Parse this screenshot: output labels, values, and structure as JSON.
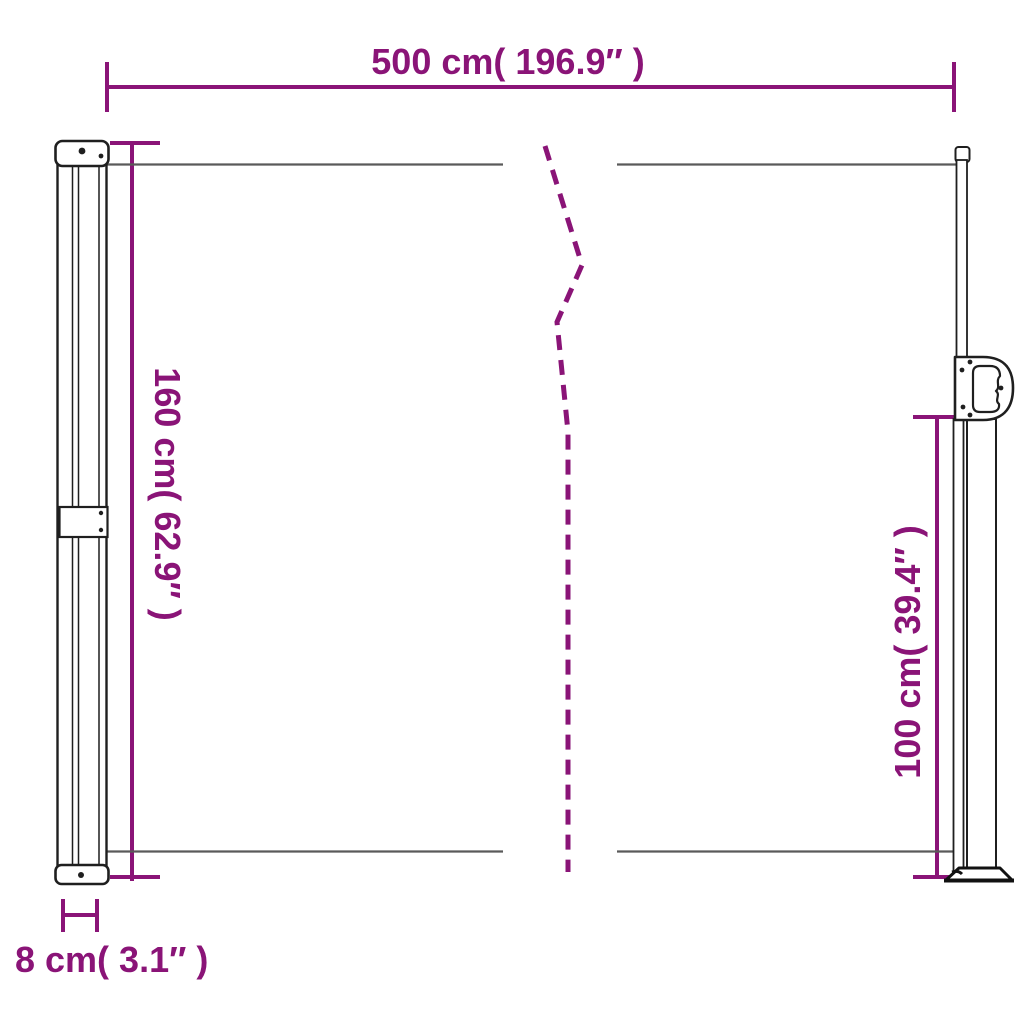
{
  "diagram": {
    "type": "product-dimension-diagram",
    "subject": "retractable-side-awning",
    "dimensions": {
      "width": {
        "label": "500 cm( 196.9″ )"
      },
      "height_left": {
        "label": "160 cm( 62.9″ )"
      },
      "height_right": {
        "label": "100 cm( 39.4″ )"
      },
      "depth": {
        "label": "8 cm( 3.1″ )"
      }
    },
    "colors": {
      "dimension_accent": "#8a1477",
      "drawing_outline": "#1f1f1f",
      "fabric_line": "#5a5a5a",
      "background": "#ffffff"
    }
  }
}
